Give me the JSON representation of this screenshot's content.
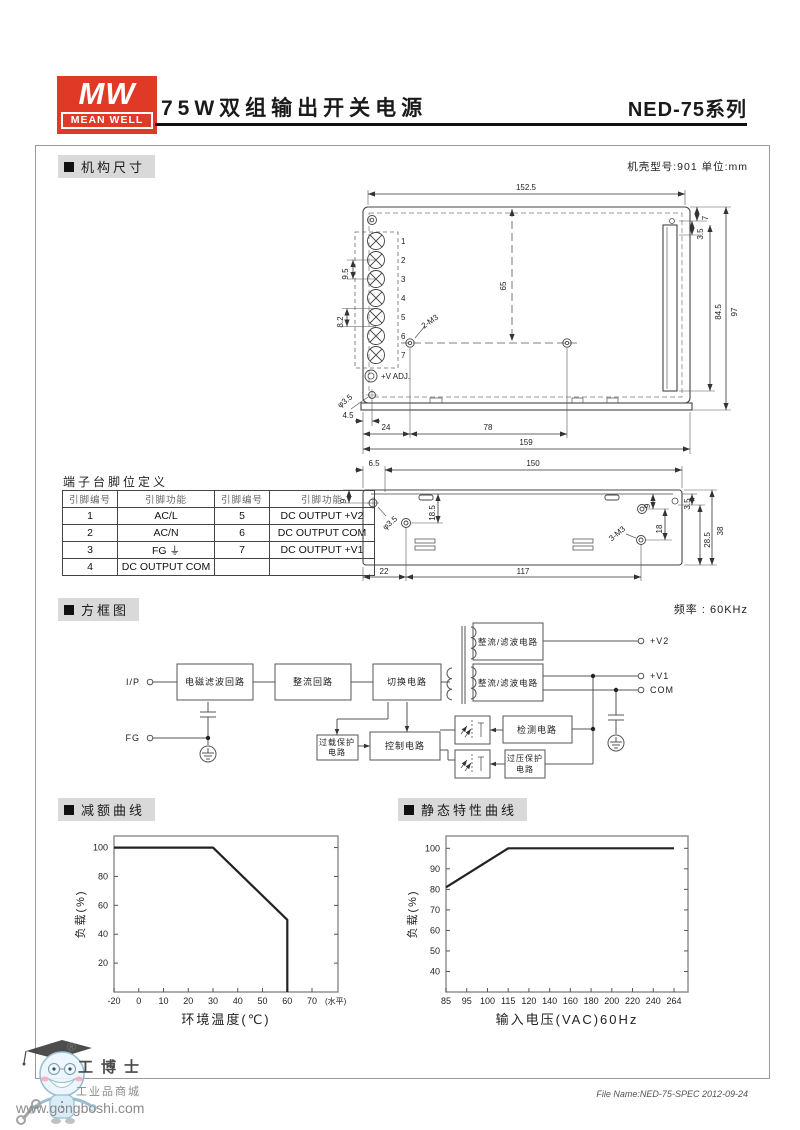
{
  "header": {
    "logo_mw": "MW",
    "logo_meanwell": "MEAN WELL",
    "title": "75W双组输出开关电源",
    "series": "NED-75系列"
  },
  "mech": {
    "section_title": "机构尺寸",
    "case_note": "机壳型号:901  单位:mm",
    "top_view": {
      "pins": [
        "1",
        "2",
        "3",
        "4",
        "5",
        "6",
        "7"
      ],
      "dim_152_5": "152.5",
      "dim_65": "65",
      "dim_7": "7",
      "dim_3_5": "3.5",
      "dim_84_5": "84.5",
      "dim_97": "97",
      "dim_9_5": "9.5",
      "dim_8_2": "8.2",
      "label_2m3": "2-M3",
      "label_vadj": "+V ADJ.",
      "label_phi": "φ3.5",
      "dim_4_5": "4.5",
      "dim_24": "24",
      "dim_78": "78",
      "dim_159": "159"
    },
    "side_view": {
      "dim_6_5": "6.5",
      "dim_150": "150",
      "dim_9_left": "9",
      "label_phi": "φ3.5",
      "dim_18_5": "18.5",
      "dim_9_right": "9",
      "dim_18": "18",
      "label_3m3": "3-M3",
      "dim_3_5": "3.5",
      "dim_28_5": "28.5",
      "dim_38": "38",
      "dim_22": "22",
      "dim_117": "117"
    },
    "pin_table": {
      "title": "端子台脚位定义",
      "headers": [
        "引脚编号",
        "引脚功能",
        "引脚编号",
        "引脚功能"
      ],
      "rows": [
        [
          "1",
          "AC/L",
          "5",
          "DC OUTPUT +V2"
        ],
        [
          "2",
          "AC/N",
          "6",
          "DC OUTPUT COM"
        ],
        [
          "3",
          "FG ⏚",
          "7",
          "DC OUTPUT +V1"
        ],
        [
          "4",
          "DC OUTPUT COM",
          "",
          ""
        ]
      ]
    }
  },
  "block": {
    "section_title": "方框图",
    "freq_note": "频率 : 60KHz",
    "labels": {
      "ip": "I/P",
      "fg": "FG",
      "emi": "电磁滤波回路",
      "rectifier": "整流回路",
      "switching": "切换电路",
      "rect_filter_1": "整流/滤波电路",
      "rect_filter_2": "整流/滤波电路",
      "olp": [
        "过载保护",
        "电路"
      ],
      "control": "控制电路",
      "detect": "检测电路",
      "ovp": [
        "过压保护",
        "电路"
      ],
      "v2": "+V2",
      "v1": "+V1",
      "com": "COM"
    }
  },
  "chart_data": [
    {
      "type": "line",
      "title": "减额曲线",
      "xlabel": "环境温度(℃)",
      "ylabel": "负载(%)",
      "x_ticks": [
        -20,
        0,
        10,
        20,
        30,
        40,
        50,
        60,
        70
      ],
      "x_note": "(水平)",
      "y_ticks": [
        20,
        40,
        60,
        80,
        100
      ],
      "ylim": [
        0,
        108
      ],
      "x_inset": 26,
      "grid": false,
      "series": [
        {
          "name": "负载",
          "points": [
            [
              -20,
              100
            ],
            [
              30,
              100
            ],
            [
              60,
              50
            ],
            [
              60,
              0
            ]
          ]
        }
      ]
    },
    {
      "type": "line",
      "title": "静态特性曲线",
      "xlabel": "输入电压(VAC)60Hz",
      "ylabel": "负载(%)",
      "x_ticks": [
        85,
        95,
        100,
        115,
        120,
        140,
        160,
        180,
        200,
        220,
        240,
        264
      ],
      "y_ticks": [
        40,
        50,
        60,
        70,
        80,
        90,
        100
      ],
      "ylim": [
        30,
        106
      ],
      "x_inset": 14,
      "grid": false,
      "series": [
        {
          "name": "负载",
          "points": [
            [
              85,
              81
            ],
            [
              115,
              100
            ],
            [
              264,
              100
            ]
          ]
        }
      ]
    }
  ],
  "footer": {
    "reg": "®",
    "brand": "工博士",
    "mall": "工业品商城",
    "url": "www.gongboshi.com",
    "file_note": "File Name:NED-75-SPEC  2012-09-24"
  }
}
